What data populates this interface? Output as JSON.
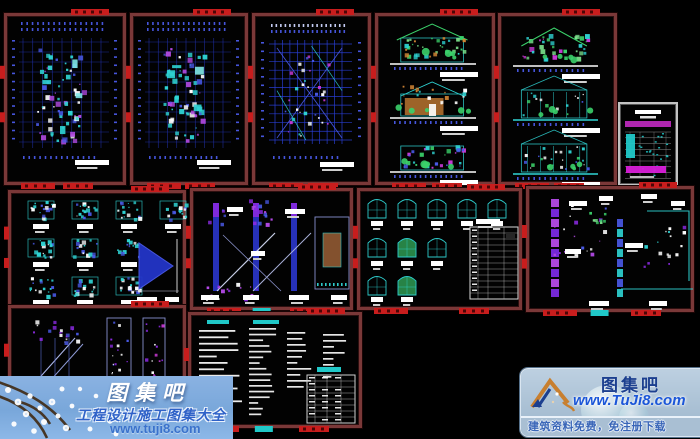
{
  "page": {
    "width": 700,
    "height": 439,
    "background": "#000000",
    "description": "preview collage of villa construction CAD drawing sheets"
  },
  "colors": {
    "sheet_border": "#7a3838",
    "tag_red": "#c81d1d",
    "tag_cyan": "#20c8c8",
    "cad_cyan": "#2fd4d4",
    "cad_blue": "#2a3fd8",
    "cad_blue2": "#4a5ae8",
    "cad_purple": "#8a2ae0",
    "cad_magenta": "#cc3ad8",
    "cad_green": "#3bd06a",
    "cad_orange": "#cf8434",
    "cad_white": "#ffffff",
    "dim_blue": "#2030a8",
    "index_magenta": "#d81ed8",
    "watermark_band_blue": "#82ache",
    "link_blue": "#1b56d8"
  },
  "panels": [
    {
      "id": "floor-plan-1",
      "kind": "plan",
      "x": 4,
      "y": 13,
      "w": 122,
      "h": 172,
      "seed": 1
    },
    {
      "id": "floor-plan-2",
      "kind": "plan",
      "x": 130,
      "y": 13,
      "w": 118,
      "h": 172,
      "seed": 2
    },
    {
      "id": "roof-plan",
      "kind": "roofplan",
      "x": 252,
      "y": 13,
      "w": 119,
      "h": 172,
      "seed": 3
    },
    {
      "id": "elevations-1",
      "kind": "elev1",
      "x": 375,
      "y": 13,
      "w": 120,
      "h": 172,
      "seed": 4
    },
    {
      "id": "elevations-2",
      "kind": "elev2",
      "x": 498,
      "y": 13,
      "w": 119,
      "h": 172,
      "seed": 5
    },
    {
      "id": "sheet-index",
      "kind": "indextable",
      "x": 618,
      "y": 102,
      "w": 62,
      "h": 86,
      "seed": 6,
      "frame": "gray"
    },
    {
      "id": "details-grid",
      "kind": "detailsgrid",
      "x": 8,
      "y": 190,
      "w": 178,
      "h": 118,
      "seed": 7
    },
    {
      "id": "stair-sections",
      "kind": "stairsection",
      "x": 190,
      "y": 188,
      "w": 163,
      "h": 122,
      "seed": 8
    },
    {
      "id": "window-schedule",
      "kind": "windows",
      "x": 357,
      "y": 188,
      "w": 165,
      "h": 122,
      "seed": 9
    },
    {
      "id": "wall-details",
      "kind": "walldetails",
      "x": 526,
      "y": 186,
      "w": 168,
      "h": 126,
      "seed": 10
    },
    {
      "id": "stair-details",
      "kind": "stairdetails",
      "x": 8,
      "y": 305,
      "w": 178,
      "h": 125,
      "seed": 11
    },
    {
      "id": "design-notes",
      "kind": "notes",
      "x": 188,
      "y": 312,
      "w": 174,
      "h": 116,
      "seed": 12
    }
  ],
  "watermark_left": {
    "site_name": "图集吧",
    "slogan": "工程设计施工图集大全",
    "url": "www.tuji8.com"
  },
  "watermark_right": {
    "site_name": "图集吧",
    "url": "www.TuJi8.com",
    "slogan": "建筑资料免费，免注册下载"
  }
}
